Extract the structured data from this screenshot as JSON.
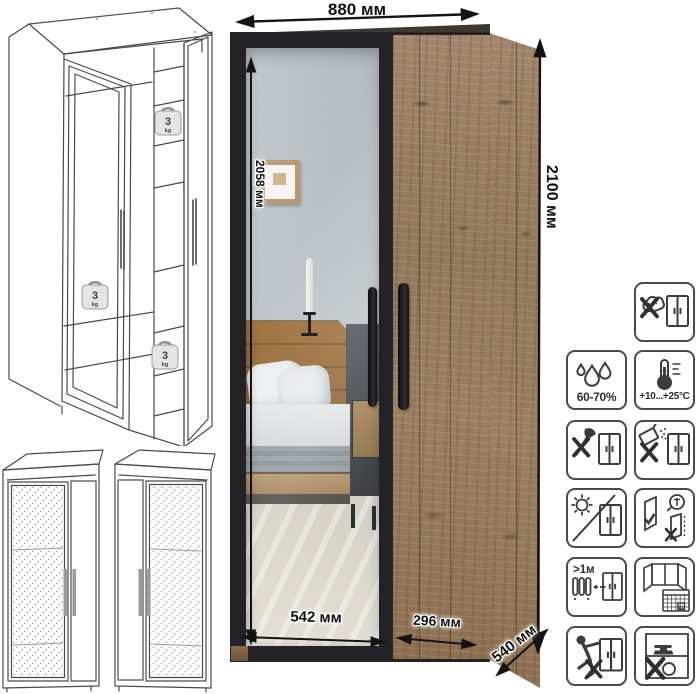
{
  "product": {
    "dimensions": {
      "width": "880 мм",
      "height": "2100 мм",
      "mirror_height": "2058 мм",
      "mirror_door_width": "542 мм",
      "wood_door_width": "296 мм",
      "depth": "540 мм"
    },
    "load_badges": [
      {
        "value": "3",
        "unit": "kg"
      },
      {
        "value": "3",
        "unit": "kg"
      },
      {
        "value": "3",
        "unit": "kg"
      }
    ]
  },
  "care": {
    "humidity": "60-70%",
    "temperature": "+10...+25°C",
    "heat_distance": ">1м",
    "calendar_day": "21",
    "icons": [
      "no-wet-cleaning",
      "humidity-range",
      "temperature-range",
      "no-sharp-tools",
      "no-abrasive-cleaners",
      "avoid-direct-sunlight",
      "door-adjustment",
      "keep-distance-from-heat",
      "ventilate-room",
      "no-leaning",
      "no-heavy-objects"
    ]
  },
  "colors": {
    "frame_black": "#232327",
    "wood": "#977b5d",
    "mirror": "#c3c9cc",
    "dimension_text": "#111111",
    "icon_stroke": "#3c3c3c"
  }
}
